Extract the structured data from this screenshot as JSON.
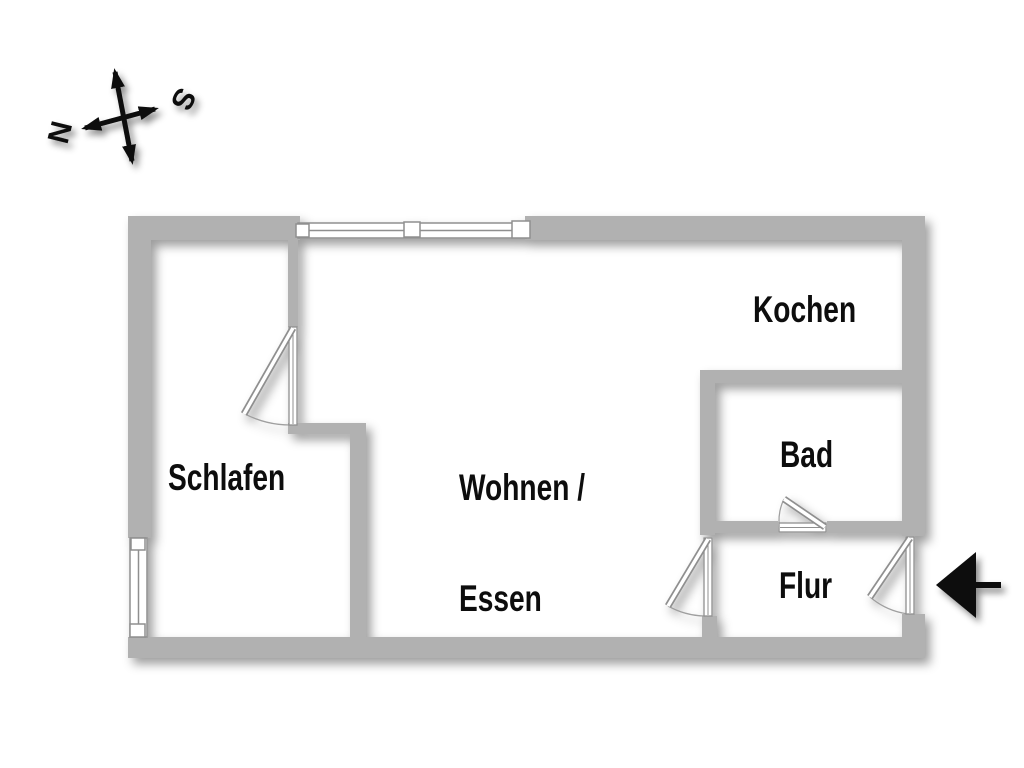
{
  "compass": {
    "north": "N",
    "south": "S"
  },
  "rooms": {
    "schlafen": {
      "label": "Schlafen"
    },
    "wohnen_essen": {
      "line1": "Wohnen /",
      "line2": "Essen"
    },
    "kochen": {
      "label": "Kochen"
    },
    "bad": {
      "label": "Bad"
    },
    "flur": {
      "label": "Flur"
    }
  },
  "icons": {
    "compass": "compass-rose-icon",
    "entrance": "entrance-arrow-icon"
  },
  "colors": {
    "wall": "#b1b1b1",
    "frame": "#8f8f8f",
    "arc": "#9f9f9f",
    "text": "#0d0d0d",
    "symbol": "#0a0a0a",
    "background": "#ffffff"
  }
}
